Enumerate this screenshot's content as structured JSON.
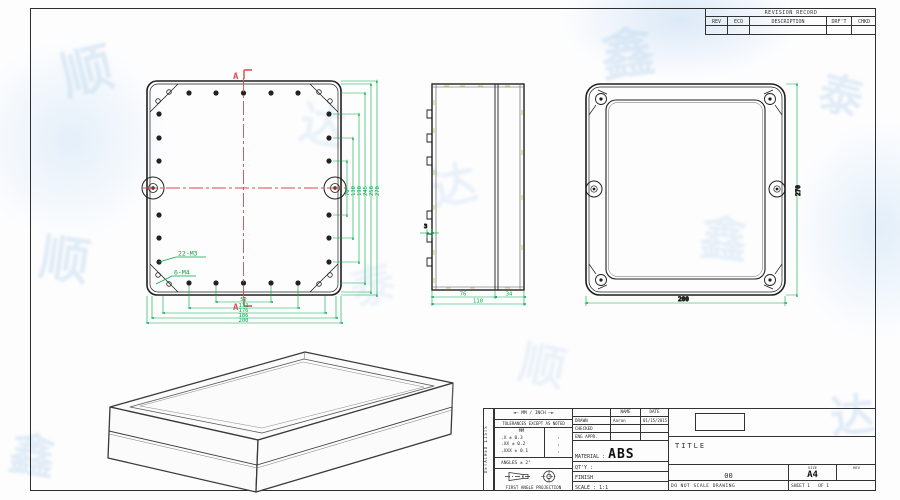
{
  "watermark": {
    "glyphs": [
      "顺",
      "达",
      "鑫",
      "泰",
      "顺",
      "达",
      "鑫",
      "泰",
      "顺",
      "达",
      "鑫",
      "泰"
    ]
  },
  "revision_table": {
    "title": "REVISION RECORD",
    "columns": [
      "REV",
      "ECO",
      "DESCRIPTION",
      "DRF'T",
      "CHKD"
    ]
  },
  "views": {
    "front": {
      "section_top": "A",
      "section_bottom": "A",
      "hole_note_small": "22-M3",
      "hole_note_large": "6-M4",
      "dims_right": [
        "70",
        "130",
        "190",
        "245",
        "258",
        "270"
      ],
      "dims_bottom": [
        "52",
        "132",
        "176",
        "186",
        "200"
      ]
    },
    "side": {
      "dim_left": "76",
      "dim_right": "34",
      "dim_total": "110",
      "dim_thickness": "3"
    },
    "back": {
      "dim_height": "270",
      "dim_width": "200"
    }
  },
  "title_block": {
    "side_strip": "DETACHED LISTS",
    "tolerance": {
      "units_line": "◄— MM / INCH —►",
      "note": "TOLERANCES EXCEPT AS NOTED",
      "unit_header": "MM",
      "rows": [
        ".X ± 0.3",
        ".XX ± 0.2",
        ".XXX ± 0.1"
      ],
      "dots": [
        "·",
        "·",
        "·"
      ],
      "angles": "ANGLES ± 2°",
      "projection": "FIRST ANGLE PROJECTION"
    },
    "approvals": {
      "name_header": "NAME",
      "date_header": "DATE",
      "rows": [
        {
          "role": "DRAWN",
          "name": "Aaron",
          "date": "01/15/2015"
        },
        {
          "role": "CHECKED",
          "name": "",
          "date": ""
        },
        {
          "role": "ENG APPR.",
          "name": "",
          "date": ""
        }
      ]
    },
    "material_label": "MATERIAL :",
    "material_value": "ABS",
    "qty_label": "QT'Y :",
    "finish_label": "FINISH",
    "scale_label": "SCALE : 1:1",
    "title_label": "TITLE",
    "drawing_number": "00",
    "size_label": "SIZE",
    "size_value": "A4",
    "rev_label": "REV",
    "note": "DO NOT SCALE DRAWING",
    "sheet": "SHEET 1",
    "of": "OF 1"
  },
  "colors": {
    "dimension_green": "#00a845",
    "centerline_red": "#d84b4b",
    "line_dark": "#1f1f1f"
  }
}
